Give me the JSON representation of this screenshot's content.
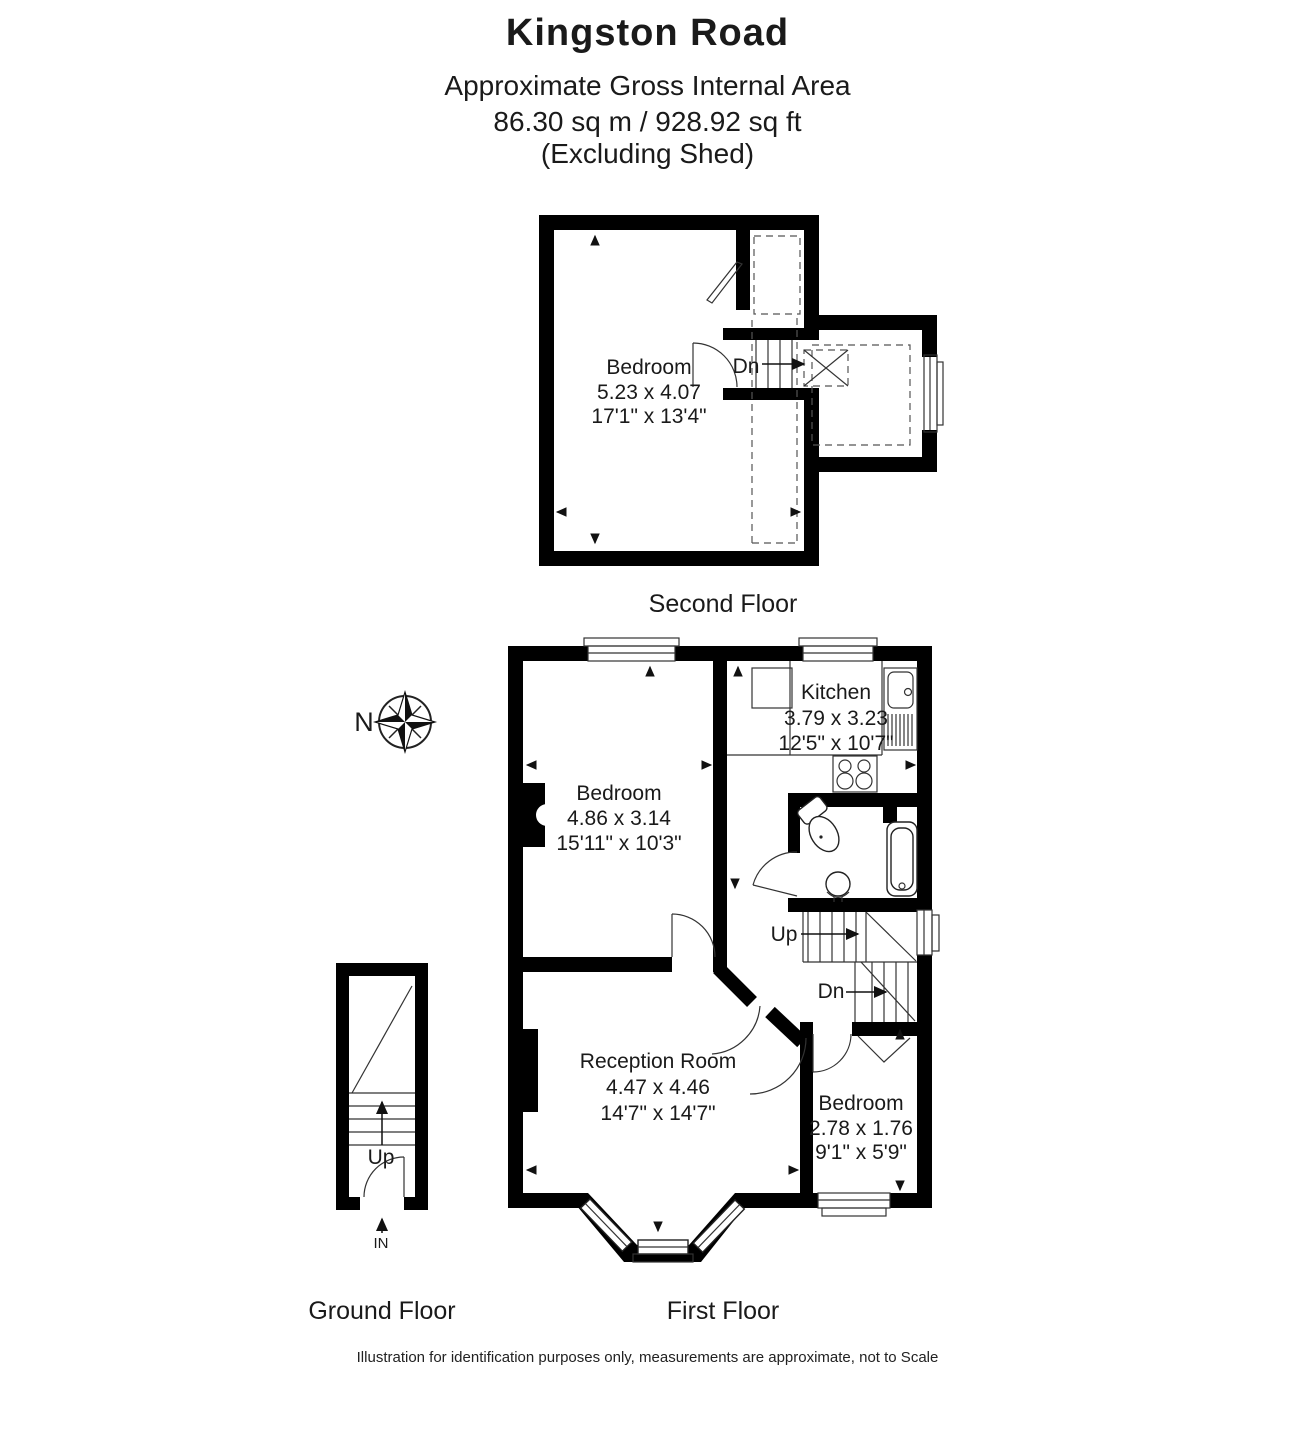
{
  "header": {
    "title": "Kingston Road",
    "line2": "Approximate Gross Internal Area",
    "line3": "86.30 sq m / 928.92 sq ft",
    "line4": "(Excluding Shed)"
  },
  "compass": {
    "north": "N"
  },
  "second_floor": {
    "label": "Second Floor",
    "bedroom": {
      "name": "Bedroom",
      "metric": "5.23 x 4.07",
      "imperial": "17'1\" x 13'4\""
    },
    "stair_down": "Dn"
  },
  "first_floor": {
    "label": "First Floor",
    "kitchen": {
      "name": "Kitchen",
      "metric": "3.79 x 3.23",
      "imperial": "12'5\" x 10'7\""
    },
    "bedroom": {
      "name": "Bedroom",
      "metric": "4.86 x 3.14",
      "imperial": "15'11\" x 10'3\""
    },
    "reception": {
      "name": "Reception Room",
      "metric": "4.47 x 4.46",
      "imperial": "14'7\" x 14'7\""
    },
    "bedroom2": {
      "name": "Bedroom",
      "metric": "2.78 x 1.76",
      "imperial": "9'1\" x 5'9\""
    },
    "stair_up": "Up",
    "stair_down": "Dn"
  },
  "ground_floor": {
    "label": "Ground Floor",
    "stair_up": "Up",
    "entrance": "IN"
  },
  "footer": "Illustration for identification purposes only, measurements are approximate, not to Scale",
  "colors": {
    "wall": "#000000",
    "line": "#333333",
    "text": "#1a1a1a"
  }
}
